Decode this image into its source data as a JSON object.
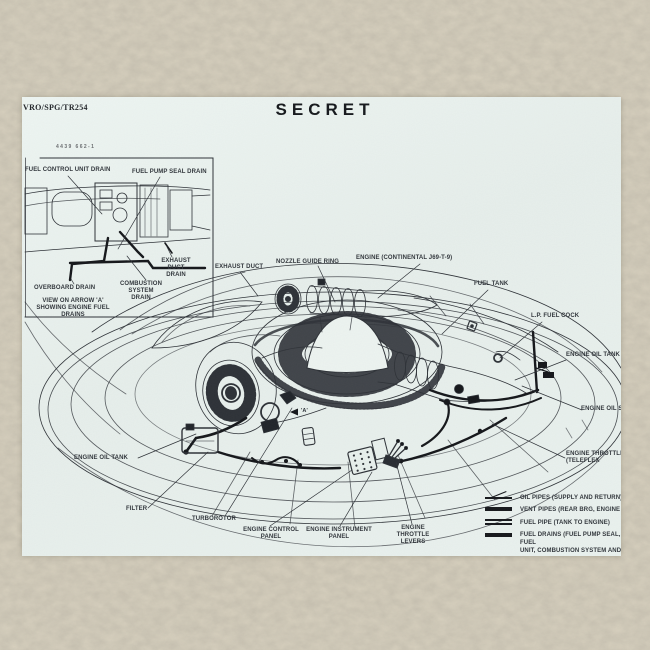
{
  "colors": {
    "background": "#d8d1bf",
    "paper": "#eaf2ef",
    "ink": "#2d3137",
    "pipe_black": "#14161a"
  },
  "header": {
    "doc_ref": "VRO/SPG/TR254",
    "classification": "SECRET",
    "figure_number": "4439 662-1"
  },
  "inset": {
    "labels": {
      "fuel_control_unit_drain": "FUEL CONTROL UNIT DRAIN",
      "fuel_pump_seal_drain": "FUEL PUMP SEAL DRAIN",
      "exhaust_duct_drain": "EXHAUST DUCT\nDRAIN",
      "overboard_drain": "OVERBOARD DRAIN",
      "combustion_system_drain": "COMBUSTION SYSTEM\nDRAIN"
    },
    "caption": "VIEW ON ARROW 'A'\nSHOWING ENGINE FUEL DRAINS"
  },
  "diagram": {
    "arrow_marker": "'A'",
    "labels": {
      "exhaust_duct": "EXHAUST DUCT",
      "nozzle_guide_ring": "NOZZLE GUIDE RING",
      "engine_continental": "ENGINE (CONTINENTAL J69-T-9)",
      "fuel_tank": "FUEL TANK",
      "lp_fuel_cock": "L.P. FUEL COCK",
      "engine_oil_tank_right": "ENGINE OIL TANK",
      "engine_oil_st": "ENGINE OIL ST",
      "engine_throttle_teleflex": "ENGINE THROTTLE\n(TELEFLEX",
      "engine_oil_tank_left": "ENGINE OIL TANK",
      "filter": "FILTER",
      "turborotor": "TURBOROTOR",
      "engine_control_panel": "ENGINE CONTROL\nPANEL",
      "engine_instrument_panel": "ENGINE INSTRUMENT\nPANEL",
      "engine_throttle_levers": "ENGINE THROTTLE\nLEVERS"
    }
  },
  "legend": {
    "items": [
      {
        "symbol": "oil-pipes",
        "text": "OIL PIPES (SUPPLY AND RETURN)"
      },
      {
        "symbol": "vent-pipes",
        "text": "VENT PIPES (REAR BRG, ENGINE AN"
      },
      {
        "symbol": "fuel-pipe",
        "text": "FUEL PIPE (TANK TO ENGINE)"
      },
      {
        "symbol": "fuel-drains",
        "text": "FUEL DRAINS (FUEL PUMP SEAL, FUEL\nUNIT, COMBUSTION SYSTEM AND E\nDUCT DRAIN)"
      }
    ]
  }
}
